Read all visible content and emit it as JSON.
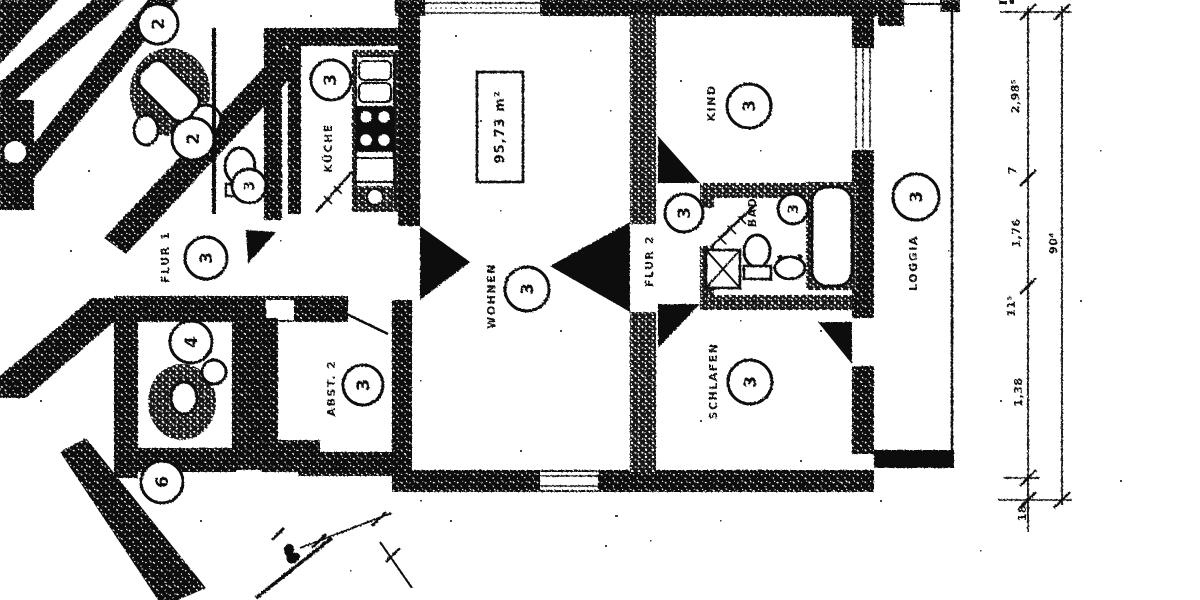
{
  "document": {
    "type": "scanned apartment floor plan"
  },
  "apartment": {
    "area_label": "95,73 m²",
    "unit_number": "3",
    "rooms": [
      {
        "id": "kueche",
        "label": "KÜCHE",
        "unit": "3"
      },
      {
        "id": "wohnen",
        "label": "WOHNEN",
        "unit": "3"
      },
      {
        "id": "kind",
        "label": "KIND",
        "unit": "3"
      },
      {
        "id": "flur1",
        "label": "FLUR 1",
        "unit": "3"
      },
      {
        "id": "flur2",
        "label": "FLUR 2",
        "unit": "3"
      },
      {
        "id": "bad",
        "label": "BAD",
        "unit": "3"
      },
      {
        "id": "schlafen",
        "label": "SCHLAFEN",
        "unit": "3"
      },
      {
        "id": "abst2",
        "label": "ABST. 2",
        "unit": "3"
      },
      {
        "id": "loggia",
        "label": "LOGGIA",
        "unit": "3"
      }
    ]
  },
  "neighbors": {
    "units": [
      "2",
      "2",
      "3",
      "4",
      "6"
    ]
  },
  "dims": {
    "chain": [
      "2,98⁵",
      "7",
      "1,76",
      "11⁵",
      "1,38",
      "18"
    ],
    "overall": "90⁴"
  },
  "colors": {
    "ink": "#0d0d0d",
    "paper": "#ffffff"
  }
}
